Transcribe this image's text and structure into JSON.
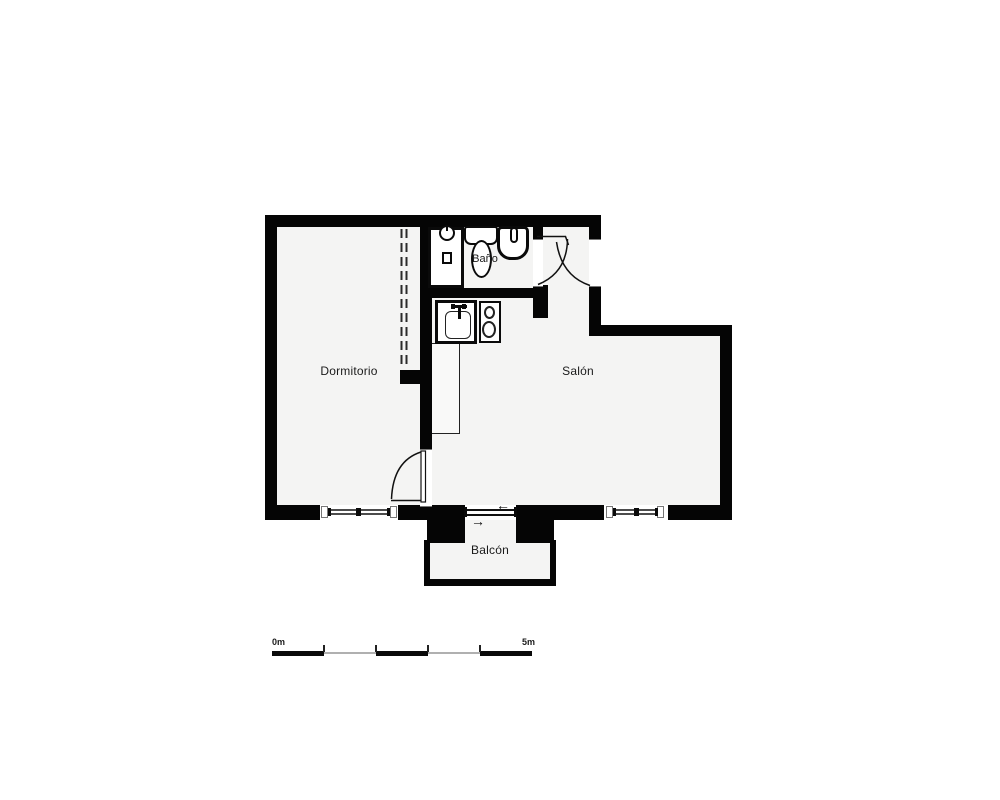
{
  "diagram": {
    "type": "floor-plan",
    "rooms": {
      "dormitorio": {
        "label": "Dormitorio"
      },
      "salon": {
        "label": "Salón"
      },
      "bano": {
        "label": "Baño"
      },
      "balcon": {
        "label": "Balcón"
      }
    },
    "fixtures": [
      "washing-machine",
      "toilet",
      "washbasin",
      "kitchen-sink",
      "stove-two-burners",
      "kitchen-counter"
    ],
    "doors": [
      "entrance-door-swing",
      "bathroom-door-swing",
      "bedroom-door-swing",
      "balcony-sliding-door",
      "wardrobe-dashed-partition"
    ],
    "windows": [
      "dormitorio-window",
      "salon-window"
    ],
    "icons": {
      "slide_left_arrow": "←",
      "slide_right_arrow": "→"
    },
    "scale_bar": {
      "start_label": "0m",
      "end_label": "5m",
      "segments": 5,
      "total_meters": 5
    },
    "colors": {
      "wall": "#050505",
      "floor": "#f4f4f3",
      "background": "#ffffff",
      "line": "#1a1a1a",
      "scale_alt_segment": "#b0b0b0"
    }
  }
}
